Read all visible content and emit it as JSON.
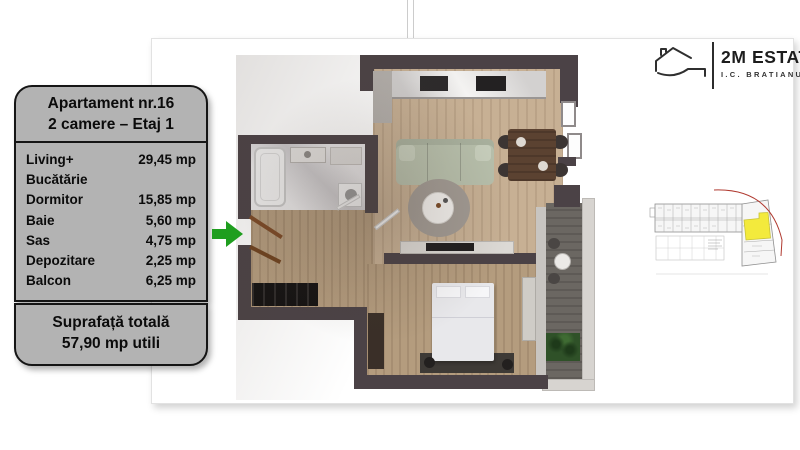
{
  "logo": {
    "title": "2M ESTATE",
    "subtitle": "I.C. BRATIANU",
    "icon": "house-outline-icon"
  },
  "info_panel": {
    "title_line1": "Apartament nr.16",
    "title_line2": "2 camere – Etaj 1",
    "rooms": [
      {
        "label": "Living+",
        "label2": "Bucătărie",
        "value": "29,45 mp"
      },
      {
        "label": "Dormitor",
        "value": "15,85 mp"
      },
      {
        "label": "Baie",
        "value": "5,60 mp"
      },
      {
        "label": "Sas",
        "value": "4,75 mp"
      },
      {
        "label": "Depozitare",
        "value": "2,25 mp"
      },
      {
        "label": "Balcon",
        "value": "6,25 mp"
      }
    ],
    "total_line1": "Suprafață totală",
    "total_line2": "57,90 mp utili"
  },
  "entrance": {
    "icon": "green-arrow-right-icon",
    "color": "#1f9e1f"
  },
  "floor_plan": {
    "type": "3d-rendered-top-view",
    "rooms_depicted": [
      "living-kitchen",
      "dormitor",
      "baie",
      "sas",
      "depozitare",
      "balcon"
    ]
  },
  "mini_plan": {
    "icon": "building-storey-plan-thumbnail",
    "highlight_color": "#f3ea3c",
    "boundary_line_color": "#b03a30"
  },
  "colors": {
    "panel_bg": "#b3b3b3",
    "panel_border": "#151515",
    "arrow_green": "#1f9e1f",
    "wall_dark": "#4b4246",
    "wood_floor": "#c7b094",
    "sofa_sage": "#b7bfab",
    "marble": "#d8d6d8",
    "balcony_floor": "#6b6762",
    "card_bg": "#ffffff"
  }
}
